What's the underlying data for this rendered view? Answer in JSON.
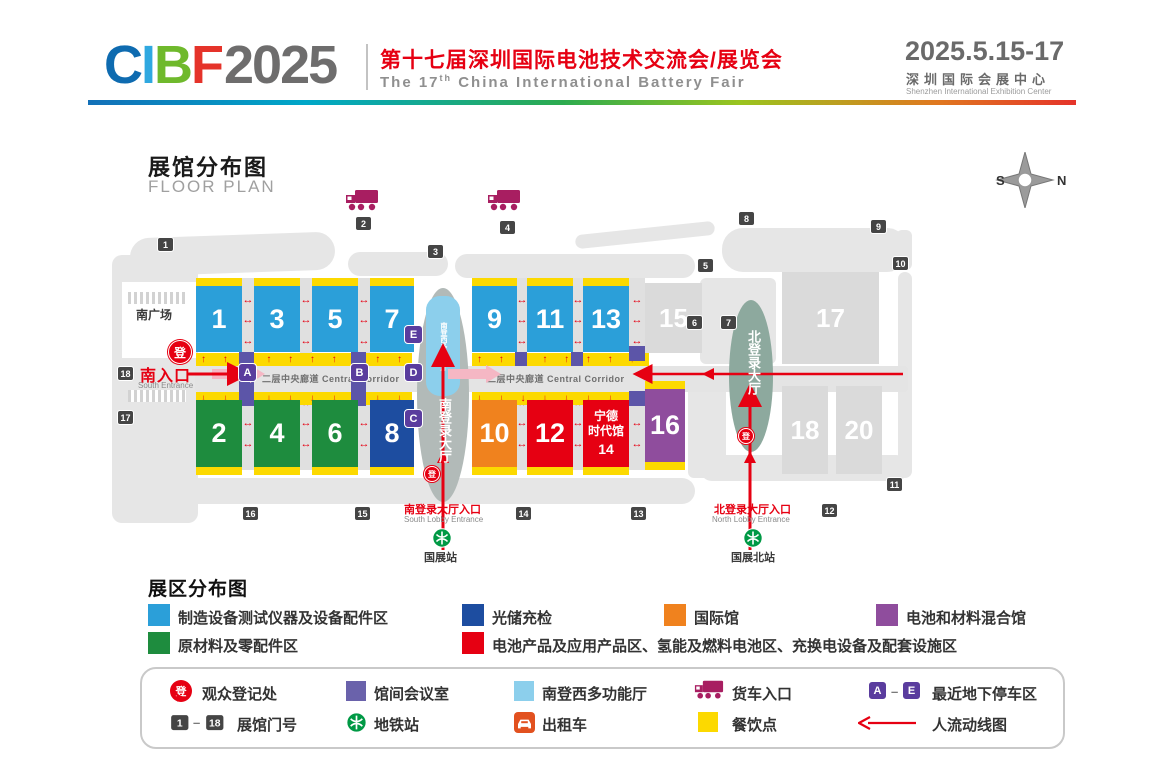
{
  "icons": {
    "up_row": "↑ ↑ ↑ ↑ ↑ ↑ ↑ ↑ ↑ ↑ ↑ ↑ ↑",
    "down_row": "↓ ↓ ↓ ↓ ↓ ↓ ↓ ↓ ↓ ↓ ↓ ↓ ↓",
    "lr_col": "↔\n↔\n↔",
    "reg": "登"
  },
  "header": {
    "logo_c": "C",
    "logo_i": "I",
    "logo_b": "B",
    "logo_f": "F",
    "logo_year": "2025",
    "title_cn": "第十七届深圳国际电池技术交流会/展览会",
    "title_en_1": "The 17",
    "title_en_sup": "th",
    "title_en_2": " China International Battery Fair",
    "date": "2025.5.15-17",
    "venue_cn": "深圳国际会展中心",
    "venue_en": "Shenzhen International Exhibition Center"
  },
  "floorplan": {
    "title_cn": "展馆分布图",
    "title_en": "FLOOR PLAN",
    "compass": {
      "s": "S",
      "n": "N"
    },
    "south_plaza": "南广场",
    "south_entrance_cn": "南入口",
    "south_entrance_en": "South Entrance",
    "corridor_label": "二层中央廊道 Central Corridor",
    "south_lobby": "南登录大厅",
    "north_lobby": "北登录大厅",
    "multi_hall": "南登西多功能厅",
    "south_lobby_entrance_cn": "南登录大厅入口",
    "south_lobby_entrance_en": "South Lobby Entrance",
    "north_lobby_entrance_cn": "北登录大厅入口",
    "north_lobby_entrance_en": "North Lobby Entrance",
    "metro_south": "国展站",
    "metro_north": "国展北站",
    "halls": [
      "1",
      "3",
      "5",
      "7",
      "9",
      "11",
      "13",
      "15",
      "2",
      "4",
      "6",
      "8",
      "10",
      "12",
      "16",
      "17",
      "18",
      "20"
    ],
    "catl": {
      "line1": "宁德",
      "line2": "时代馆",
      "line3": "14"
    },
    "gates": [
      "1",
      "2",
      "3",
      "4",
      "5",
      "6",
      "7",
      "8",
      "9",
      "10",
      "11",
      "12",
      "13",
      "14",
      "15",
      "16",
      "17",
      "18"
    ],
    "parking": [
      "A",
      "B",
      "C",
      "D",
      "E"
    ]
  },
  "zones": {
    "title": "展区分布图",
    "items": [
      {
        "label": "制造设备测试仪器及设备配件区",
        "color": "#2b9fd9"
      },
      {
        "label": "原材料及零配件区",
        "color": "#1e8c3e"
      },
      {
        "label": "光储充检",
        "color": "#1d4da0"
      },
      {
        "label": "电池产品及应用产品区、氢能及燃料电池区、充换电设备及配套设施区",
        "color": "#e60012"
      },
      {
        "label": "国际馆",
        "color": "#f0821e"
      },
      {
        "label": "电池和材料混合馆",
        "color": "#8f4d9d"
      }
    ]
  },
  "legend": {
    "dash": "–",
    "registration": "观众登记处",
    "meeting": "馆间会议室",
    "multi": "南登西多功能厅",
    "truck": "货车入口",
    "parking": "最近地下停车区",
    "gate": "展馆门号",
    "metro": "地铁站",
    "taxi": "出租车",
    "dining": "餐饮点",
    "flow": "人流动线图"
  }
}
